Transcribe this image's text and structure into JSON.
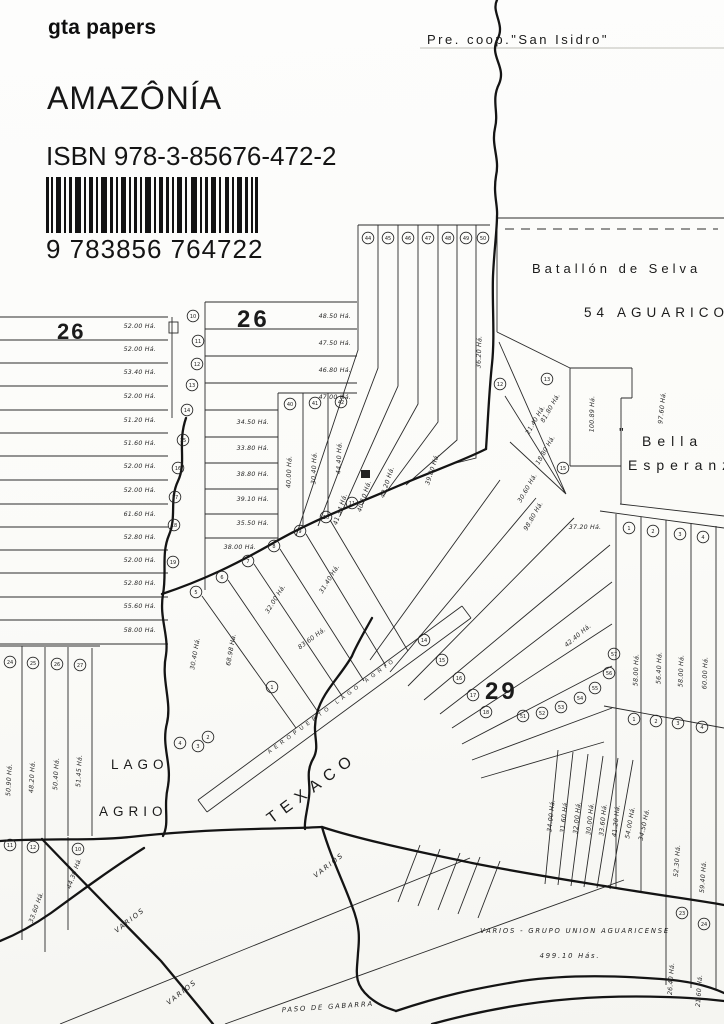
{
  "cover": {
    "publisher": "gta papers",
    "title": "AMAZÔNÍA",
    "isbn_line": "ISBN 978-3-85676-472-2",
    "ean_digits": "9 783856 764722"
  },
  "map": {
    "san_isidro": "Pre. coop.\"San Isidro\"",
    "batallon_line1": "Batallón de Selva",
    "batallon_line2": "54 AGUARICO",
    "block_left": "26",
    "block_center": "26",
    "block_29": "29",
    "bella_quote": "\"",
    "bella_line1": "Bella",
    "bella_line2": "Esperanza",
    "lago": "LAGO",
    "agrio": "AGRIO",
    "texaco": "TEXACO",
    "aeropuerto": "AEROPUERTO LAGO AGRIO",
    "paso_de_gabarra": "PASO DE GABARRA",
    "varios_1": "VARIOS",
    "varios_2": "VARIOS",
    "varios_3": "VARIOS",
    "varios_grupo": "VARIOS - GRUPO UNION AGUARICENSE",
    "varios_total": "499.10 Hás.",
    "left_block": {
      "areas": [
        "52.00 Há.",
        "52.00 Há.",
        "53.40 Há.",
        "52.00 Há.",
        "51.20 Há.",
        "51.60 Há.",
        "52.00 Há.",
        "52.00 Há.",
        "61.60 Há.",
        "52.80 Há.",
        "52.00 Há.",
        "52.80 Há.",
        "55.60 Há.",
        "58.00 Há."
      ]
    },
    "left_col_circles": [
      "10",
      "11",
      "12",
      "13",
      "14",
      "15",
      "16",
      "17",
      "18",
      "19"
    ],
    "center_block": {
      "areas_top": [
        "48.50 Há.",
        "47.50 Há.",
        "46.80 Há.",
        "47.00 Há."
      ],
      "areas_mid": [
        "34.50 Há.",
        "33.80 Há.",
        "38.80 Há.",
        "39.10 Há.",
        "35.50 Há.",
        "38.00 Há."
      ],
      "vert_circles": [
        "40",
        "41",
        "42"
      ],
      "vert_areas": [
        "40.00 Há.",
        "30.40 Há.",
        "44.40 Há."
      ]
    },
    "top_fan": {
      "circles": [
        "44",
        "45",
        "46",
        "47",
        "48",
        "49",
        "50"
      ],
      "areas": [
        "41.34 Há.",
        "40.10 Há.",
        "42.20 Há.",
        "39.80 Há.",
        "36.20 Há."
      ]
    },
    "road_circles": [
      "5",
      "6",
      "7",
      "8",
      "9",
      "10",
      "11"
    ],
    "runway_circles": [
      "4",
      "3",
      "2",
      "1"
    ],
    "center_south_areas": [
      "30.40 Há.",
      "68.98 Há.",
      "83.60 Há.",
      "32.00 Há.",
      "31.40 Há."
    ],
    "right_wedge": {
      "circles": [
        "12",
        "13",
        "15"
      ],
      "areas": [
        "21.40 Há.",
        "81.80 Há.",
        "18.80 Há.",
        "30.60 Há.",
        "98.80 Há."
      ],
      "big_areas": [
        "100.89 Há.",
        "97.60 Há."
      ],
      "small_area": "37.20 Há."
    },
    "right_strips": {
      "row1_circles": [
        "1",
        "2",
        "3",
        "4"
      ],
      "row2_circles": [
        "1",
        "2",
        "3",
        "4"
      ],
      "areas": [
        "58.00 Há.",
        "56.40 Há.",
        "58.00 Há.",
        "60.00 Há."
      ]
    },
    "fan29": {
      "upper_circles": [
        "14",
        "15",
        "16",
        "17",
        "18"
      ],
      "arc_circles": [
        "51",
        "52",
        "53",
        "54",
        "55",
        "56",
        "57"
      ],
      "area": "42.40 Há."
    },
    "br_fan": {
      "areas": [
        "34.00 Há.",
        "31.60 Há.",
        "32.00 Há.",
        "30.00 Há.",
        "33.60 Há.",
        "41.20 Há.",
        "54.00 Há.",
        "34.50 Há."
      ],
      "right_areas": [
        "52.30 Há.",
        "59.40 Há."
      ],
      "circles": [
        "23",
        "24"
      ],
      "bottom_areas": [
        "26.40 Há.",
        "21.60 Há."
      ]
    },
    "left_strips": {
      "circles": [
        "24",
        "25",
        "26",
        "27"
      ],
      "areas": [
        "50.90 Há.",
        "48.20 Há.",
        "50.40 Há.",
        "51.45 Há."
      ],
      "row2_circles": [
        "11",
        "12",
        "10"
      ],
      "row2_area": "44.30 Há.",
      "row2_area2": "33.60 Há."
    }
  }
}
